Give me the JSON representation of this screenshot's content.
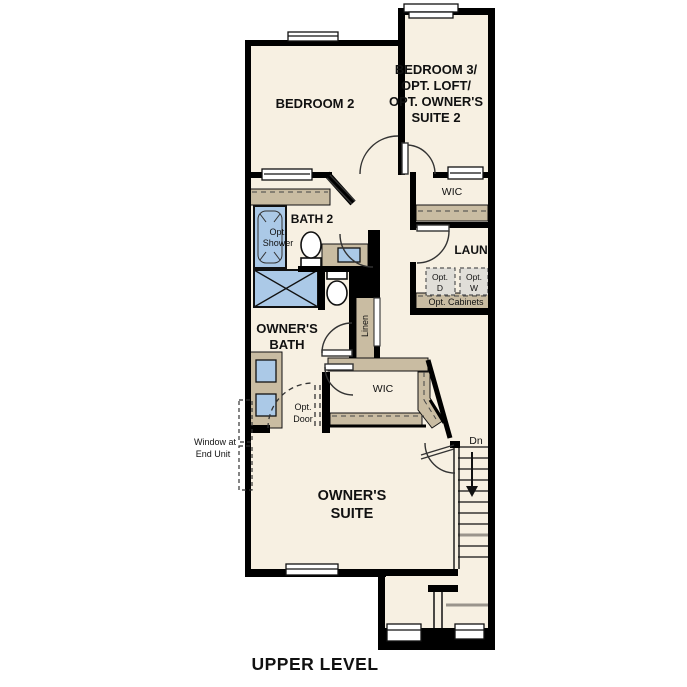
{
  "title": {
    "text": "UPPER LEVEL"
  },
  "colors": {
    "floor": "#f7f0e2",
    "wall": "#000000",
    "cabinet_tan": "#c9bca2",
    "fixture_blue": "#abc9e7",
    "appliance_gray": "#e0ded8"
  },
  "rooms": {
    "bedroom2": {
      "name": "BEDROOM 2"
    },
    "bedroom3": {
      "line1": "BEDROOM 3/",
      "line2": "OPT. LOFT/",
      "line3": "OPT. OWNER'S",
      "line4": "SUITE 2"
    },
    "wic_upper": {
      "name": "WIC"
    },
    "bath2": {
      "name": "BATH 2"
    },
    "laundry": {
      "name": "LAUN"
    },
    "owners_bath": {
      "line1": "OWNER'S",
      "line2": "BATH"
    },
    "linen": {
      "name": "Linen"
    },
    "wic_middle": {
      "name": "WIC"
    },
    "owners_suite": {
      "line1": "OWNER'S",
      "line2": "SUITE"
    }
  },
  "annotations": {
    "opt_shower": {
      "line1": "Opt.",
      "line2": "Shower"
    },
    "opt_dryer": {
      "line1": "Opt.",
      "line2": "D"
    },
    "opt_washer": {
      "line1": "Opt.",
      "line2": "W"
    },
    "opt_cabinets": {
      "text": "Opt. Cabinets"
    },
    "opt_door": {
      "line1": "Opt.",
      "line2": "Door"
    },
    "window_at_end_unit": {
      "line1": "Window at",
      "line2": "End Unit"
    },
    "stairs_down": {
      "text": "Dn"
    }
  }
}
